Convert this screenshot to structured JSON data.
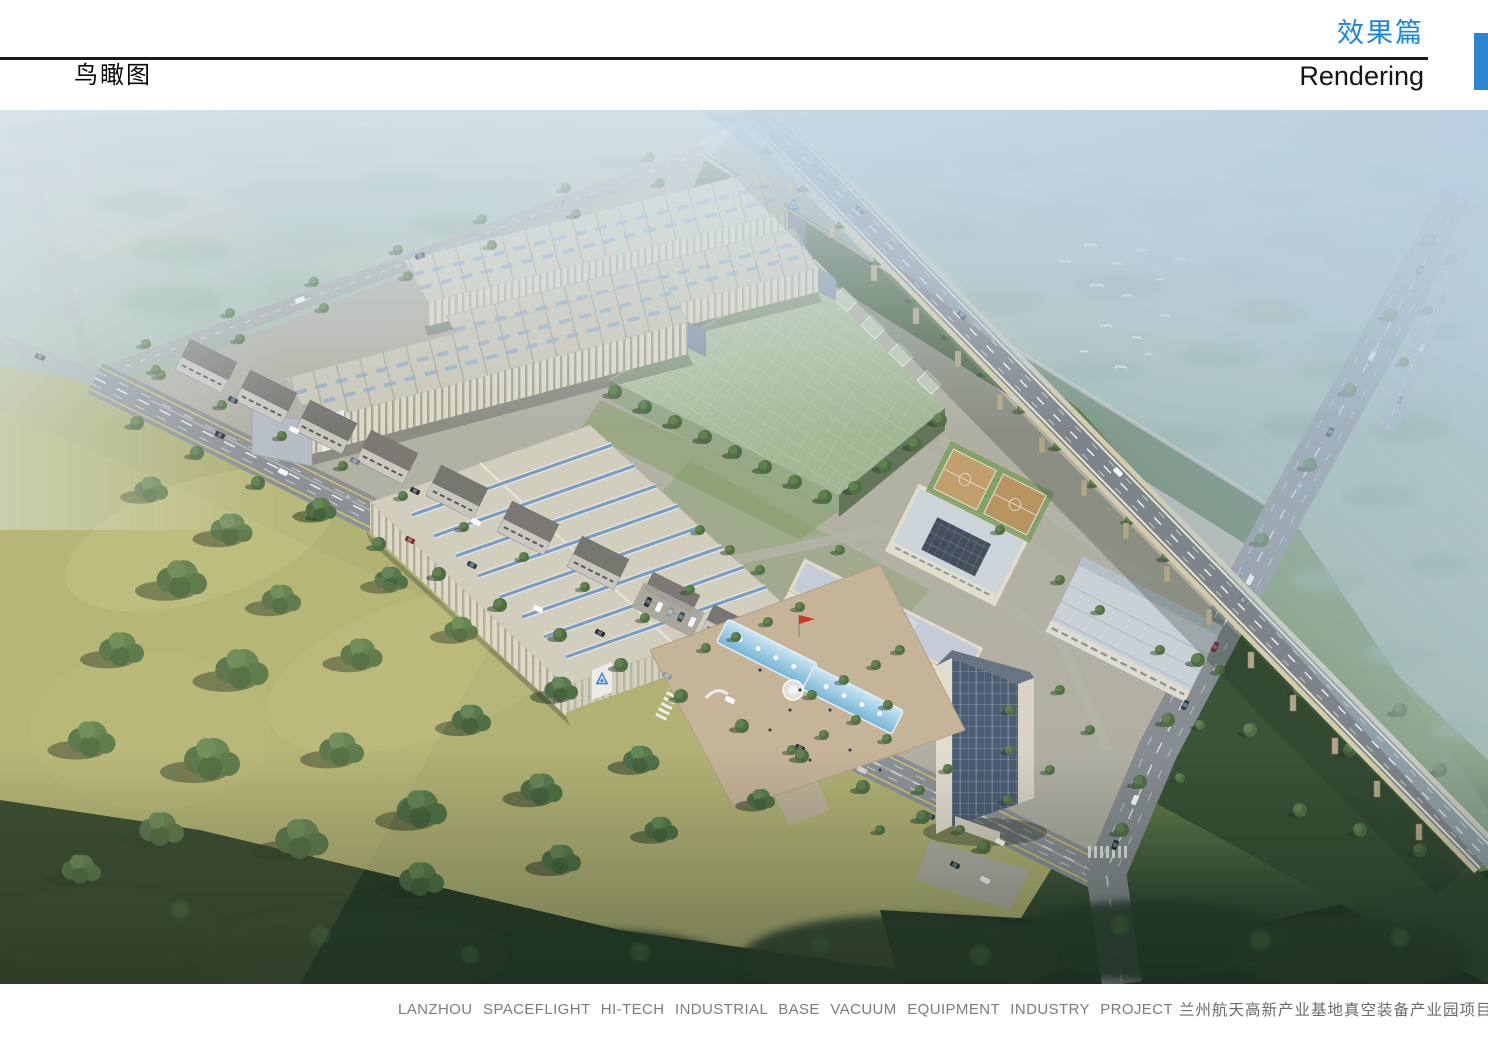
{
  "header": {
    "section_title_cn": "效果篇",
    "section_title_en": "Rendering",
    "page_label": "鸟瞰图"
  },
  "footer": {
    "project_name_en": "LANZHOU SPACEFLIGHT HI-TECH INDUSTRIAL BASE VACUUM EQUIPMENT INDUSTRY PROJECT",
    "project_name_cn": "兰州航天高新产业基地真空装备产业园项目"
  },
  "colors": {
    "accent_blue": "#1786E8",
    "tab_blue": "#2E86D2",
    "caption_marker_blue": "#3E8ED8",
    "caption_gray": "#7C7C7C"
  },
  "rendering": {
    "view": "aerial bird's-eye architectural rendering",
    "scene": "industrial park with long factory halls, translucent green enclosure, office campus with entrance plaza and pools, street-front blocks, elevated expressway viaduct, arterial roads, tree fields and flying birds"
  }
}
